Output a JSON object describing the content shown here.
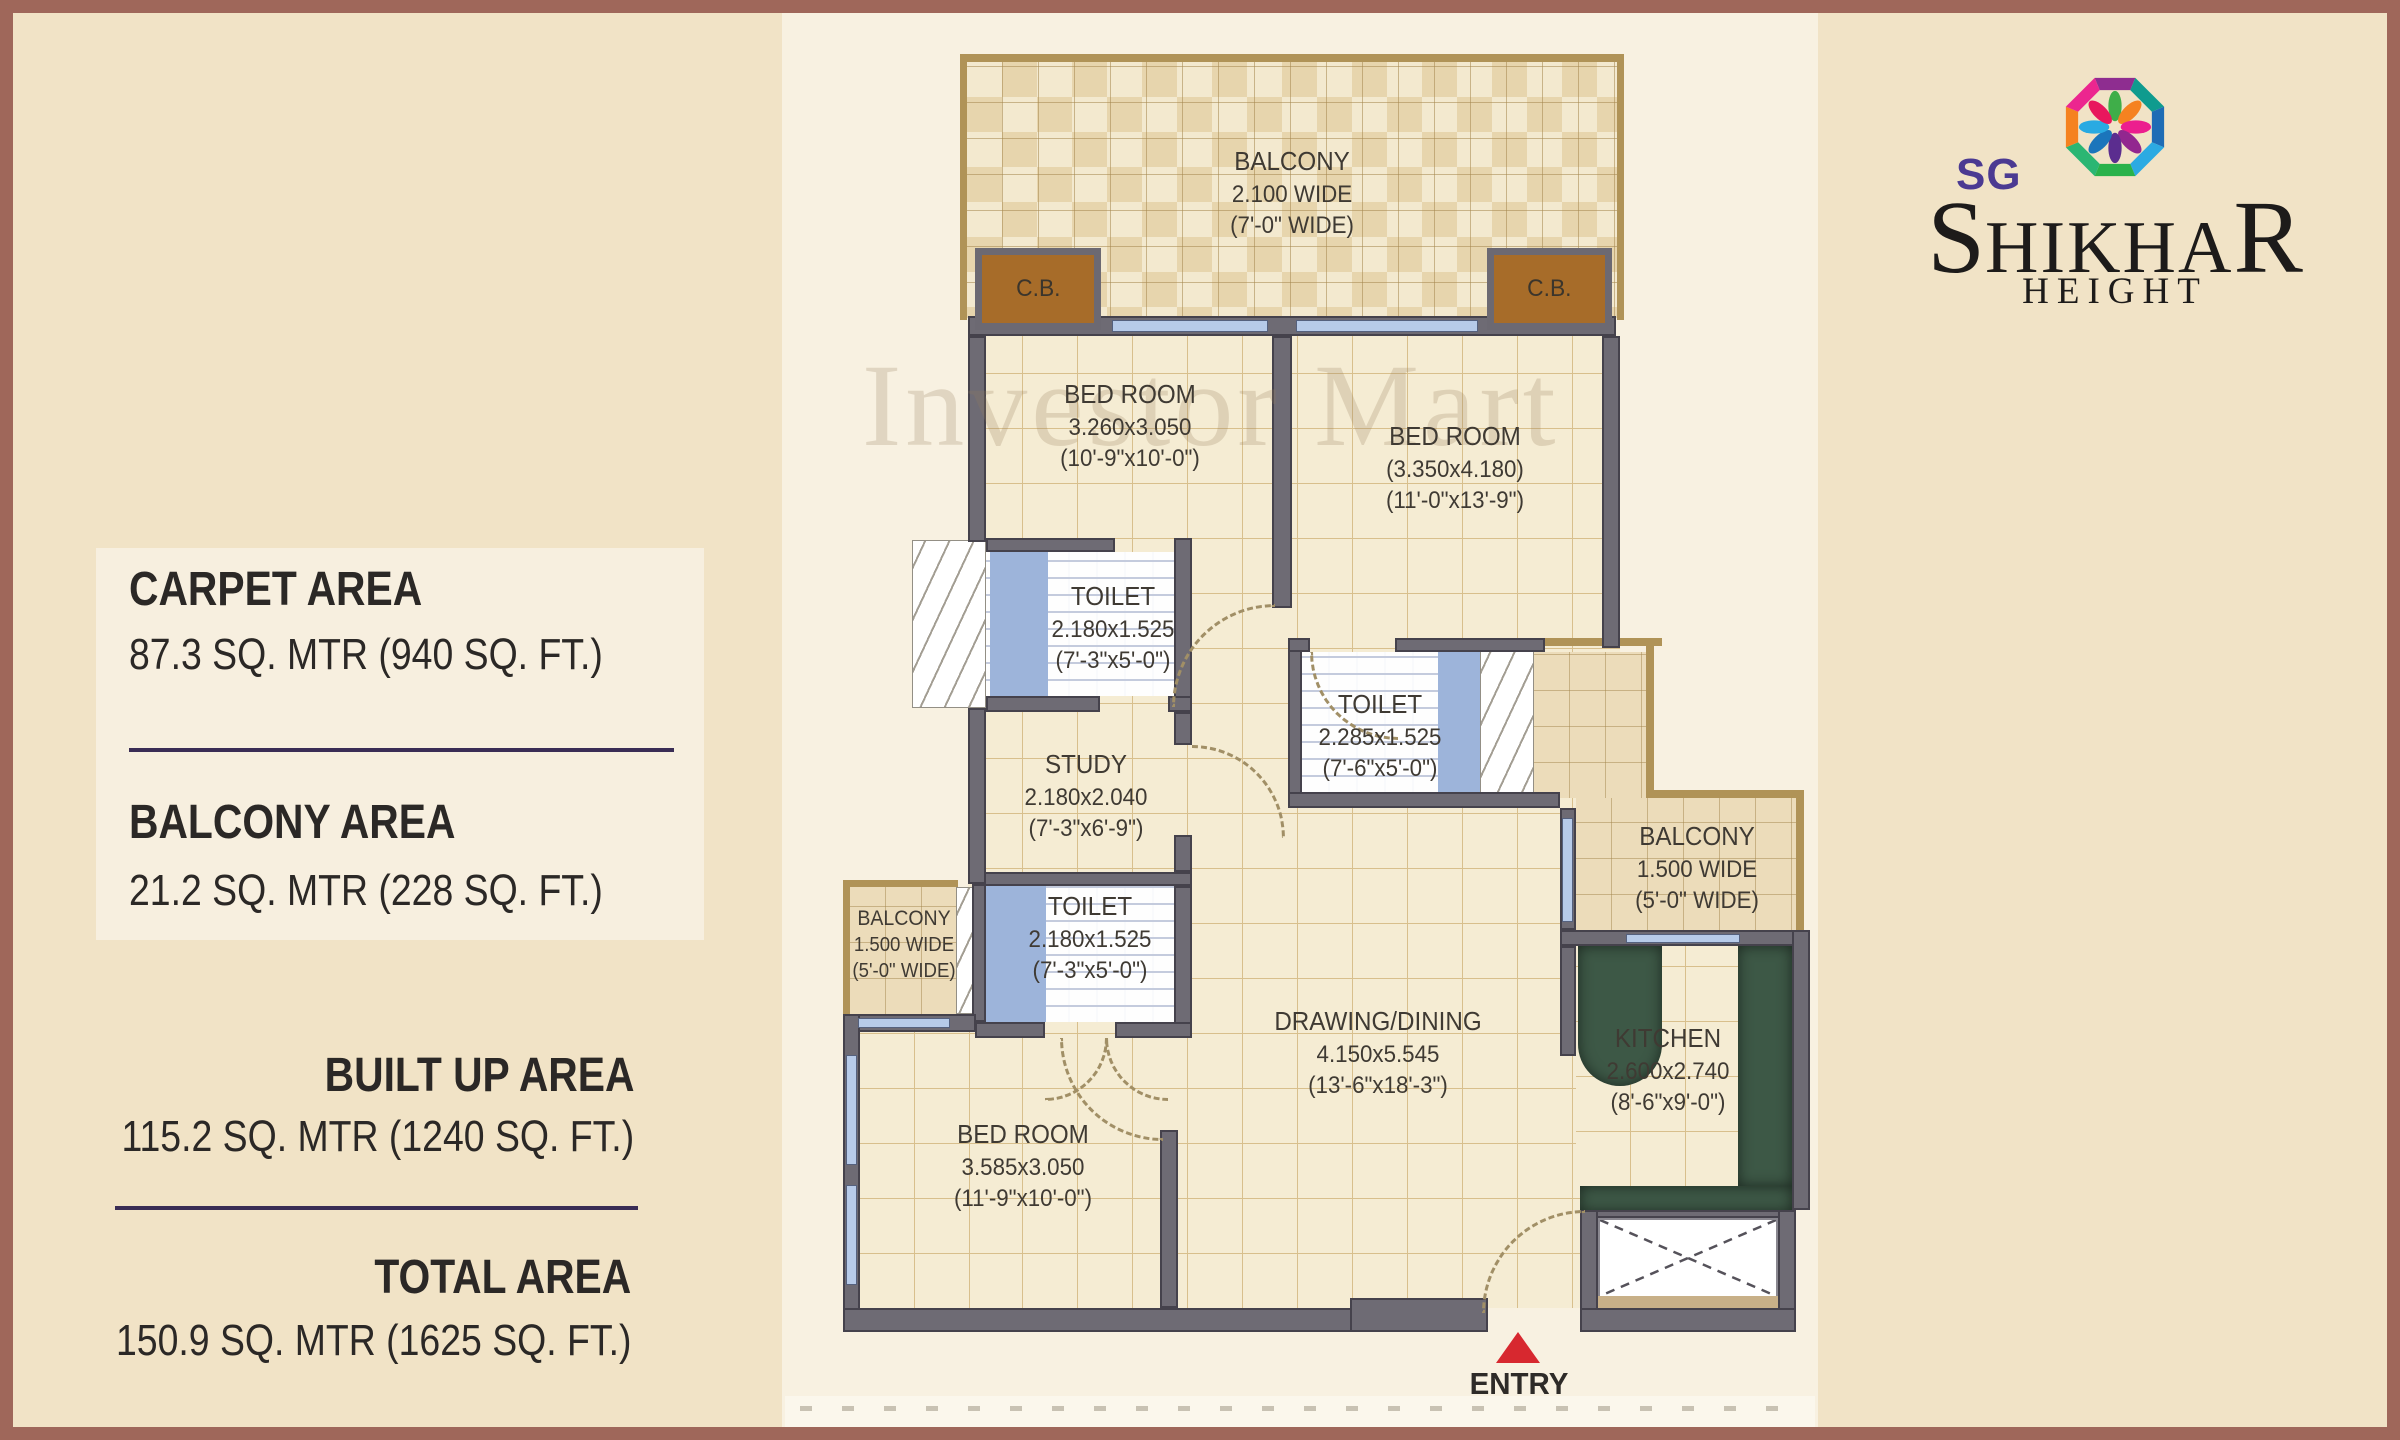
{
  "info_panel": {
    "blocks": [
      {
        "title": "CARPET AREA",
        "value": "87.3 SQ. MTR (940 SQ. FT.)"
      },
      {
        "title": "BALCONY AREA",
        "value": "21.2 SQ. MTR (228 SQ. FT.)"
      },
      {
        "title": "BUILT UP AREA",
        "value": "115.2 SQ. MTR (1240 SQ. FT.)"
      },
      {
        "title": "TOTAL AREA",
        "value": "150.9 SQ. MTR (1625 SQ. FT.)"
      }
    ]
  },
  "brand": {
    "sg": "SG",
    "name_first": "S",
    "name_mid": "HIKHA",
    "name_last": "R",
    "subtitle": "HEIGHT",
    "purple": "#4b3a92",
    "logo_ring_colors": [
      "#8e2d90",
      "#0f9b8e",
      "#1e6cb5",
      "#2caae2",
      "#2ab24b",
      "#2bb673",
      "#f58220",
      "#ec268f"
    ],
    "logo_petal_colors": [
      "#3fae49",
      "#f58220",
      "#ec1e8e",
      "#92278f",
      "#5b2d8f",
      "#1b75bb",
      "#29aae2",
      "#e8175d"
    ]
  },
  "watermark": {
    "text": "Investor Mart"
  },
  "plan": {
    "cb_label": "C.B.",
    "entry_label": "ENTRY",
    "entry_arrow_color": "#d7282f",
    "wall_color": "#6e6b74",
    "balcony_trim_color": "#b09357",
    "counter_green": "#3d5846",
    "frame_color": "#9f675a"
  },
  "rooms": {
    "balcony_top": {
      "name": "BALCONY",
      "dim_m": "2.100 WIDE",
      "dim_ft": "(7'-0\" WIDE)"
    },
    "bed1": {
      "name": "BED ROOM",
      "dim_m": "3.260x3.050",
      "dim_ft": "(10'-9\"x10'-0\")"
    },
    "bed2": {
      "name": "BED ROOM",
      "dim_m": "(3.350x4.180)",
      "dim_ft": "(11'-0\"x13'-9\")"
    },
    "toilet1": {
      "name": "TOILET",
      "dim_m": "2.180x1.525",
      "dim_ft": "(7'-3\"x5'-0\")"
    },
    "toilet2": {
      "name": "TOILET",
      "dim_m": "2.285x1.525",
      "dim_ft": "(7'-6\"x5'-0\")"
    },
    "study": {
      "name": "STUDY",
      "dim_m": "2.180x2.040",
      "dim_ft": "(7'-3\"x6'-9\")"
    },
    "toilet3": {
      "name": "TOILET",
      "dim_m": "2.180x1.525",
      "dim_ft": "(7'-3\"x5'-0\")"
    },
    "balcony_left": {
      "name": "BALCONY",
      "dim_m": "1.500 WIDE",
      "dim_ft": "(5'-0\" WIDE)"
    },
    "balcony_right": {
      "name": "BALCONY",
      "dim_m": "1.500 WIDE",
      "dim_ft": "(5'-0\" WIDE)"
    },
    "drawing": {
      "name": "DRAWING/DINING",
      "dim_m": "4.150x5.545",
      "dim_ft": "(13'-6\"x18'-3\")"
    },
    "kitchen": {
      "name": "KITCHEN",
      "dim_m": "2.600x2.740",
      "dim_ft": "(8'-6\"x9'-0\")"
    },
    "bed3": {
      "name": "BED ROOM",
      "dim_m": "3.585x3.050",
      "dim_ft": "(11'-9\"x10'-0\")"
    }
  }
}
